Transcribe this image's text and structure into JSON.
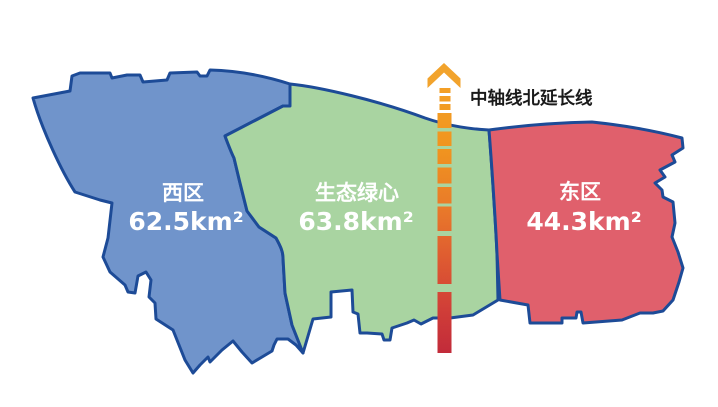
{
  "map": {
    "background": "#ffffff",
    "border_color": "#1d4b97",
    "label_text_color": "#ffffff"
  },
  "regions": [
    {
      "name": "西区",
      "area": "62.5km²",
      "color": "#7094cb"
    },
    {
      "name": "生态绿心",
      "area": "63.8km²",
      "color": "#a9d4a1"
    },
    {
      "name": "东区",
      "area": "44.3km²",
      "color": "#e0606c"
    }
  ],
  "axis_line": {
    "label": "中轴线北延长线",
    "label_color": "#1a1a1a",
    "arrow_color": "#f2a32c",
    "gradient": {
      "s0": "#f5a428",
      "s1": "#f0941f",
      "s2": "#e97a2a",
      "s3": "#de5a31",
      "s4": "#d03e38",
      "s5": "#c22b3a"
    }
  }
}
